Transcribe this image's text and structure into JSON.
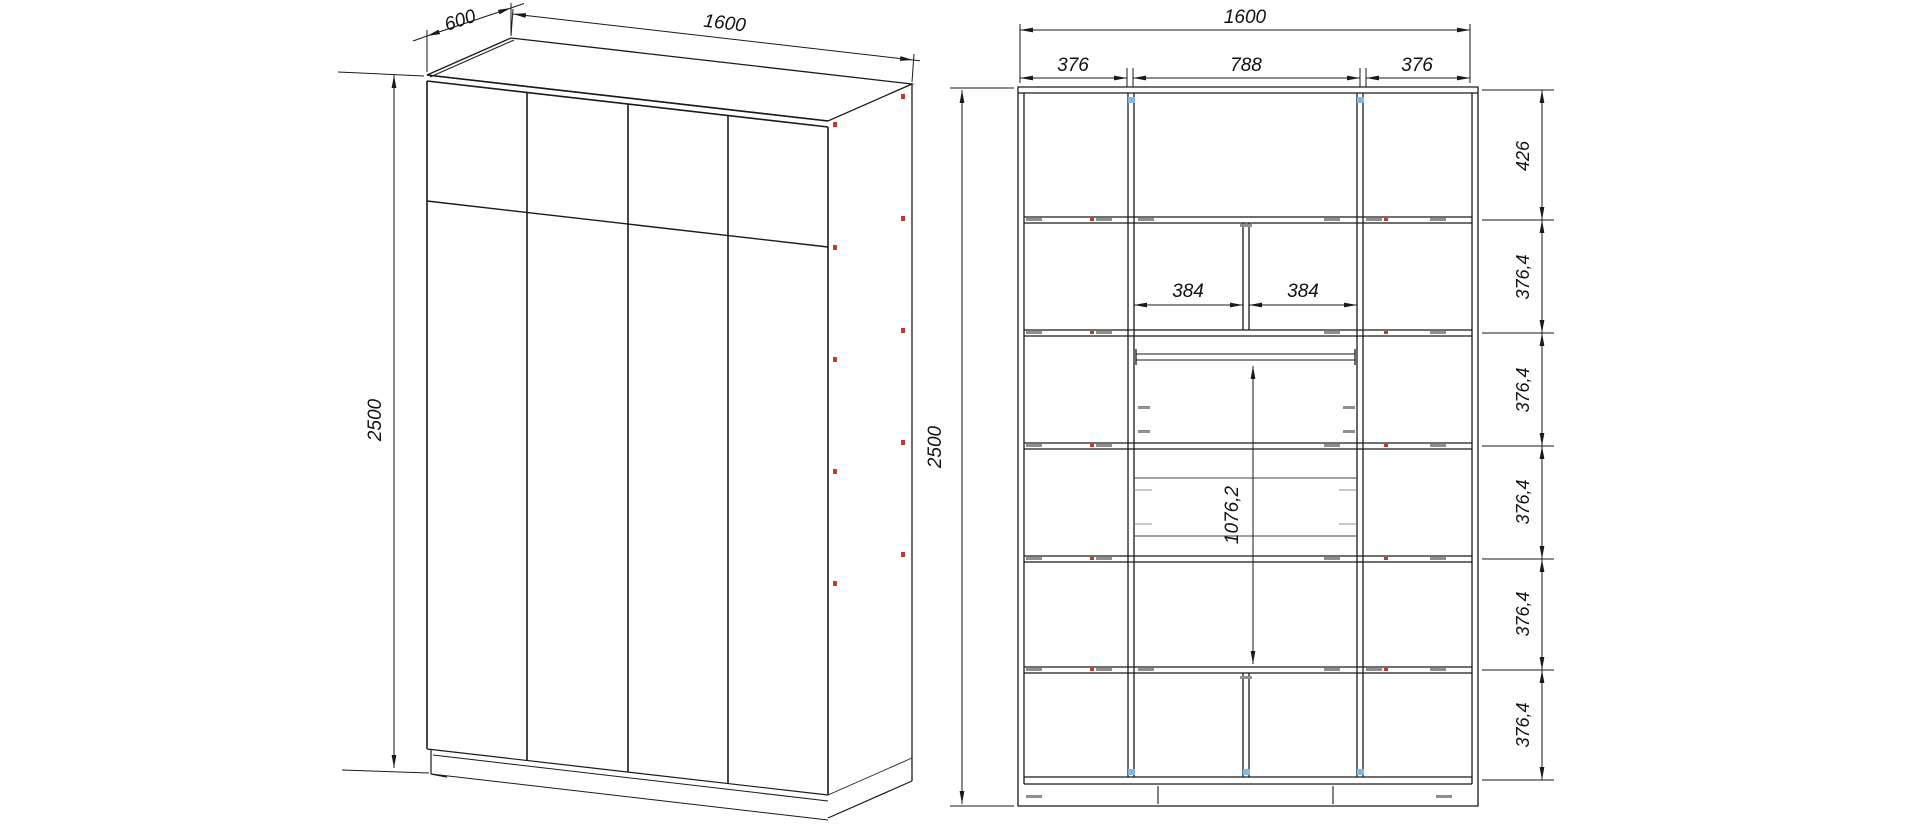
{
  "drawing": {
    "title": "wardrobe-technical-drawing",
    "perspective_view": {
      "depth_label": "600",
      "width_label": "1600",
      "height_label": "2500"
    },
    "front_view": {
      "overall_width_label": "1600",
      "column_widths": [
        "376",
        "788",
        "376"
      ],
      "inner_widths": [
        "384",
        "384"
      ],
      "height_label": "2500",
      "hanging_height_label": "1076,2",
      "row_heights": [
        "426",
        "376,4",
        "376,4",
        "376,4",
        "376,4",
        "376,4"
      ]
    },
    "colors": {
      "line": "#1a1a1a",
      "fastener_gray": "#8f8f8f",
      "fastener_red": "#c0392b",
      "fastener_blue": "#7fb8e6"
    }
  }
}
